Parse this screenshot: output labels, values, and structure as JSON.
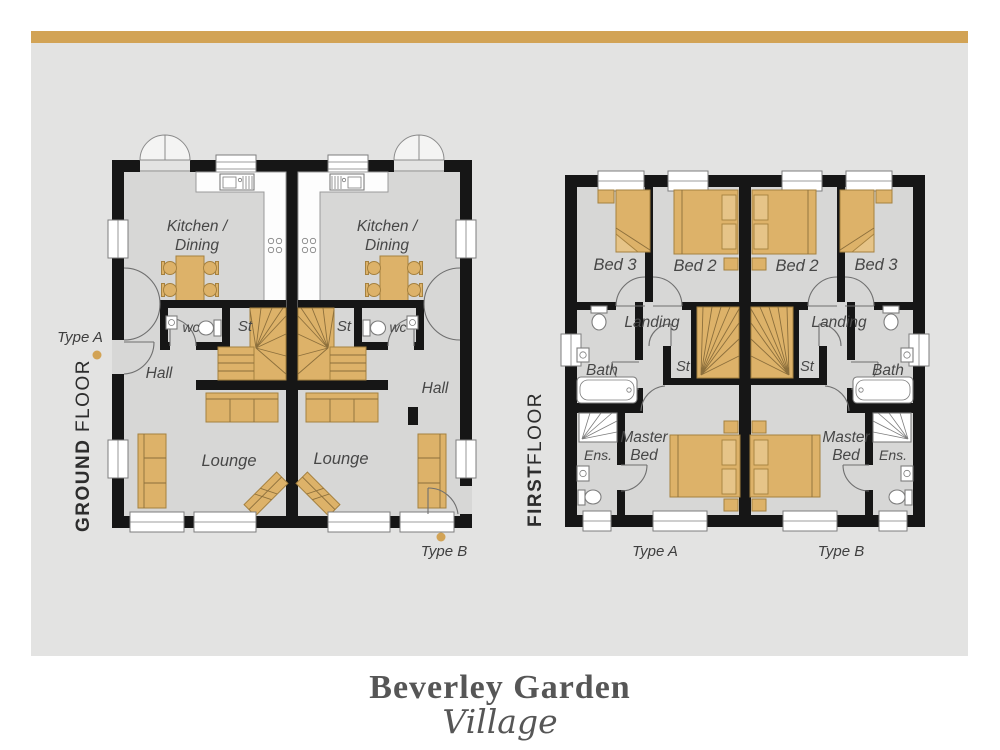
{
  "brand": {
    "line1": "Beverley Garden",
    "line2": "Village"
  },
  "colors": {
    "accent_gold": "#d2a355",
    "panel_gray": "#e3e3e2",
    "floor_gray": "#d7d7d6",
    "wall_black": "#161616",
    "furniture_tan": "#ddb269",
    "label_text": "#474747"
  },
  "ground_floor": {
    "title_primary": "GROUND",
    "title_secondary": "FLOOR",
    "type_a": "Type A",
    "type_b": "Type B",
    "rooms": {
      "kitchen_line1": "Kitchen /",
      "kitchen_line2": "Dining",
      "wc": "wc",
      "store": "St",
      "hall": "Hall",
      "lounge": "Lounge"
    }
  },
  "first_floor": {
    "title_primary": "FIRST",
    "title_secondary": "FLOOR",
    "type_a": "Type A",
    "type_b": "Type B",
    "rooms": {
      "bed3": "Bed 3",
      "bed2": "Bed 2",
      "landing": "Landing",
      "store": "St",
      "bath": "Bath",
      "master_line1": "Master",
      "master_line2": "Bed",
      "ensuite": "Ens."
    }
  }
}
